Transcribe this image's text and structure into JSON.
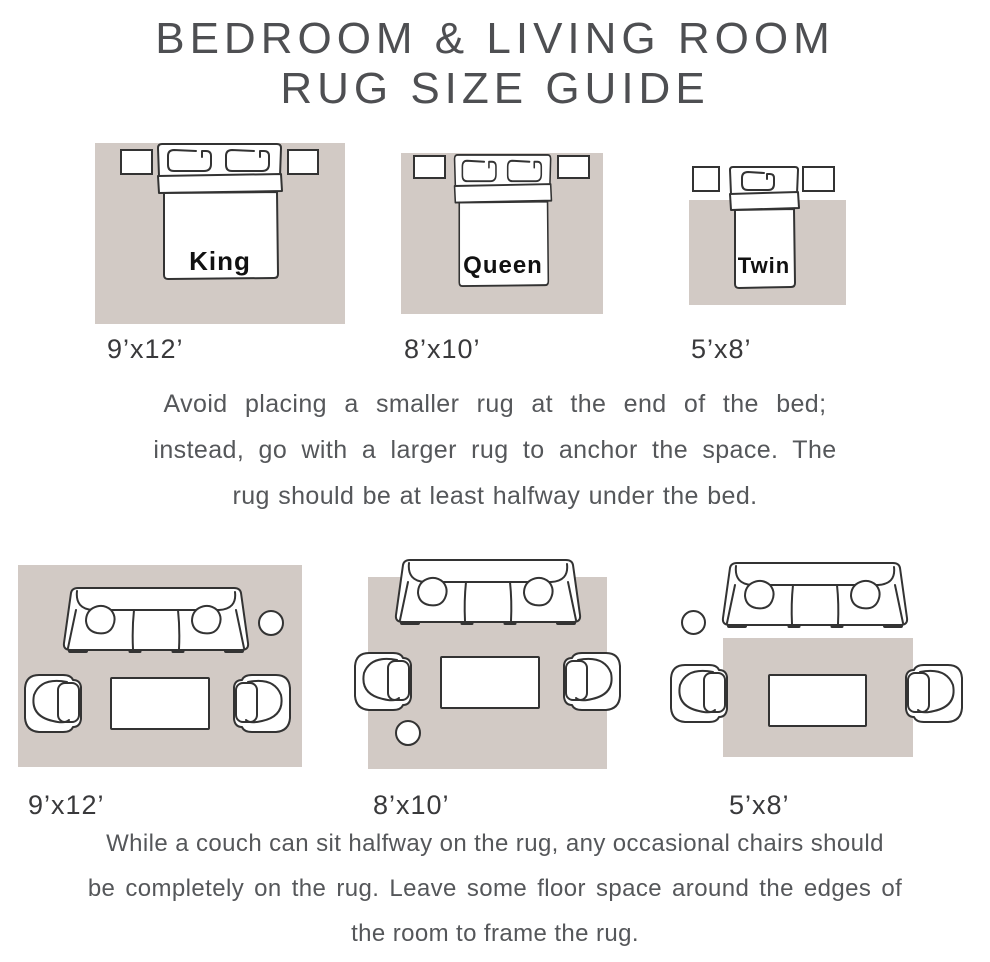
{
  "title": {
    "line1": "BEDROOM & LIVING ROOM",
    "line2": "RUG SIZE GUIDE"
  },
  "bedroom_section": {
    "diagrams": [
      {
        "bed_label": "King",
        "rug_size": "9’x12’"
      },
      {
        "bed_label": "Queen",
        "rug_size": "8’x10’"
      },
      {
        "bed_label": "Twin",
        "rug_size": "5’x8’"
      }
    ],
    "note": {
      "line1": "Avoid placing a smaller rug at the end of the bed;",
      "line2": "instead, go with a larger rug to anchor the space. The",
      "line3": "rug should be at least halfway under the bed."
    }
  },
  "living_section": {
    "diagrams": [
      {
        "rug_size": "9’x12’"
      },
      {
        "rug_size": "8’x10’"
      },
      {
        "rug_size": "5’x8’"
      }
    ],
    "note": {
      "line1": "While a couch can sit halfway on the rug, any occasional chairs should",
      "line2": "be completely on the rug. Leave some floor space around the edges of",
      "line3": "the room to frame the rug."
    }
  },
  "colors": {
    "rug": "#d2cac5",
    "stroke": "#333333",
    "text": "#55575a",
    "title": "#4e4f52",
    "bed_label": "#111111",
    "size_label": "#39393b"
  }
}
